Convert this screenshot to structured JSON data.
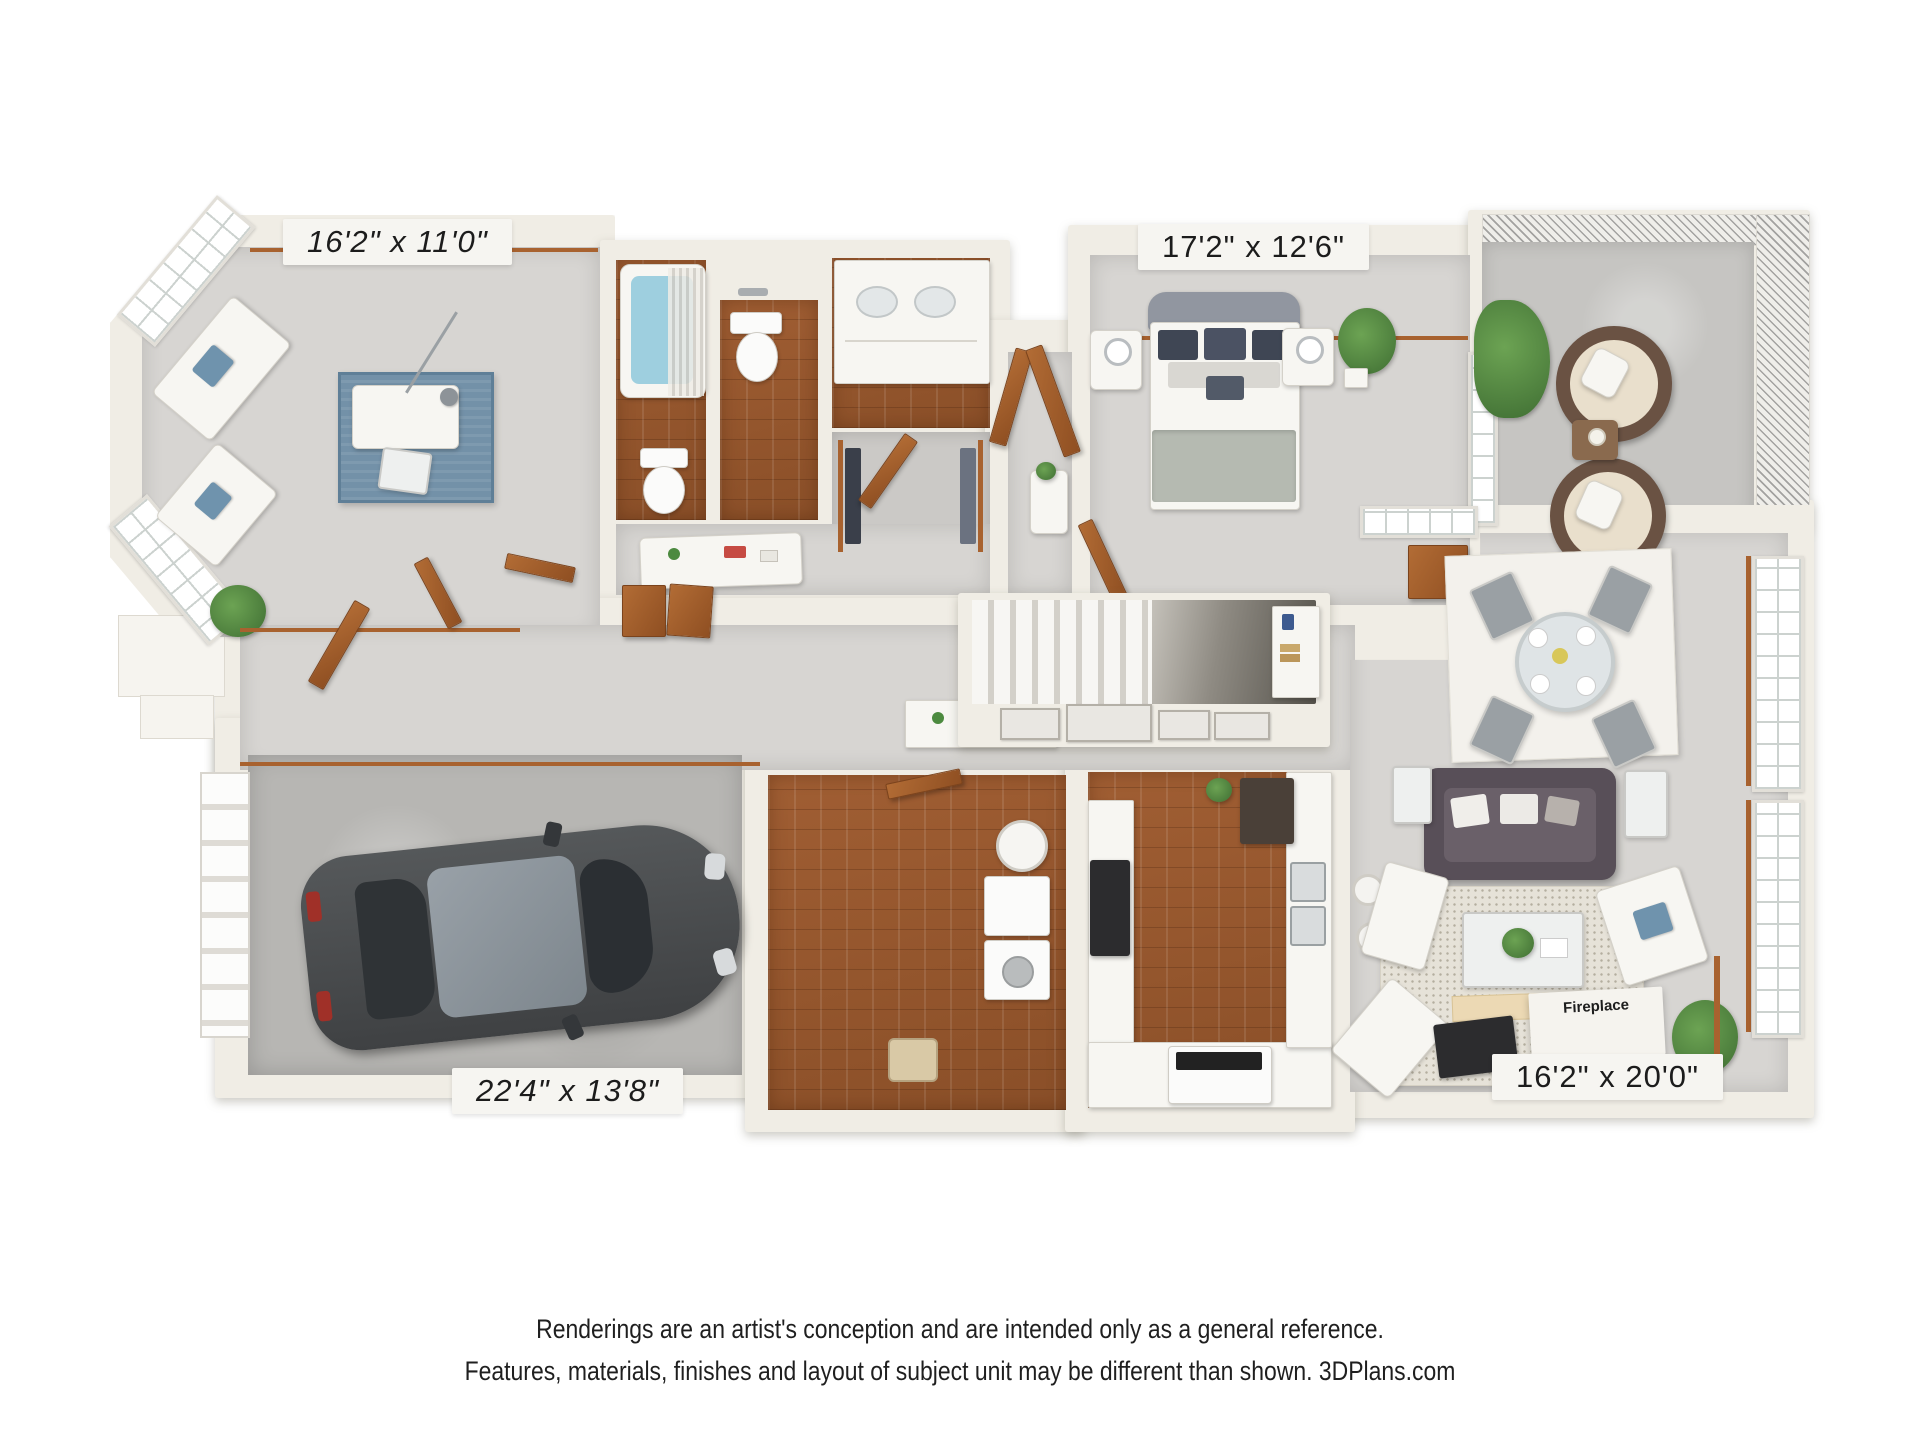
{
  "labels": {
    "office_dimensions": "16'2\" x 11'0\"",
    "bedroom_dimensions": "17'2\" x 12'6\"",
    "garage_dimensions": "22'4\" x 13'8\"",
    "living_room_dimensions": "16'2\" x 20'0\"",
    "fireplace": "Fireplace"
  },
  "disclaimer": {
    "line1": "Renderings are an artist's conception and are intended only as a general reference.",
    "line2": "Features, materials, finishes and layout of subject unit may be different than shown. 3DPlans.com"
  },
  "colors": {
    "wall": "#f0ede5",
    "carpet": "#d7d5d2",
    "wood_floor": "#9a5a30",
    "concrete": "#b7b6b3",
    "trim_wood": "#a8622f",
    "accent_blue": "#6f93ad",
    "sofa_gray": "#5d555e",
    "plant_green": "#55843f",
    "car_body": "#48494b",
    "tub_water": "#9ecfdf"
  }
}
